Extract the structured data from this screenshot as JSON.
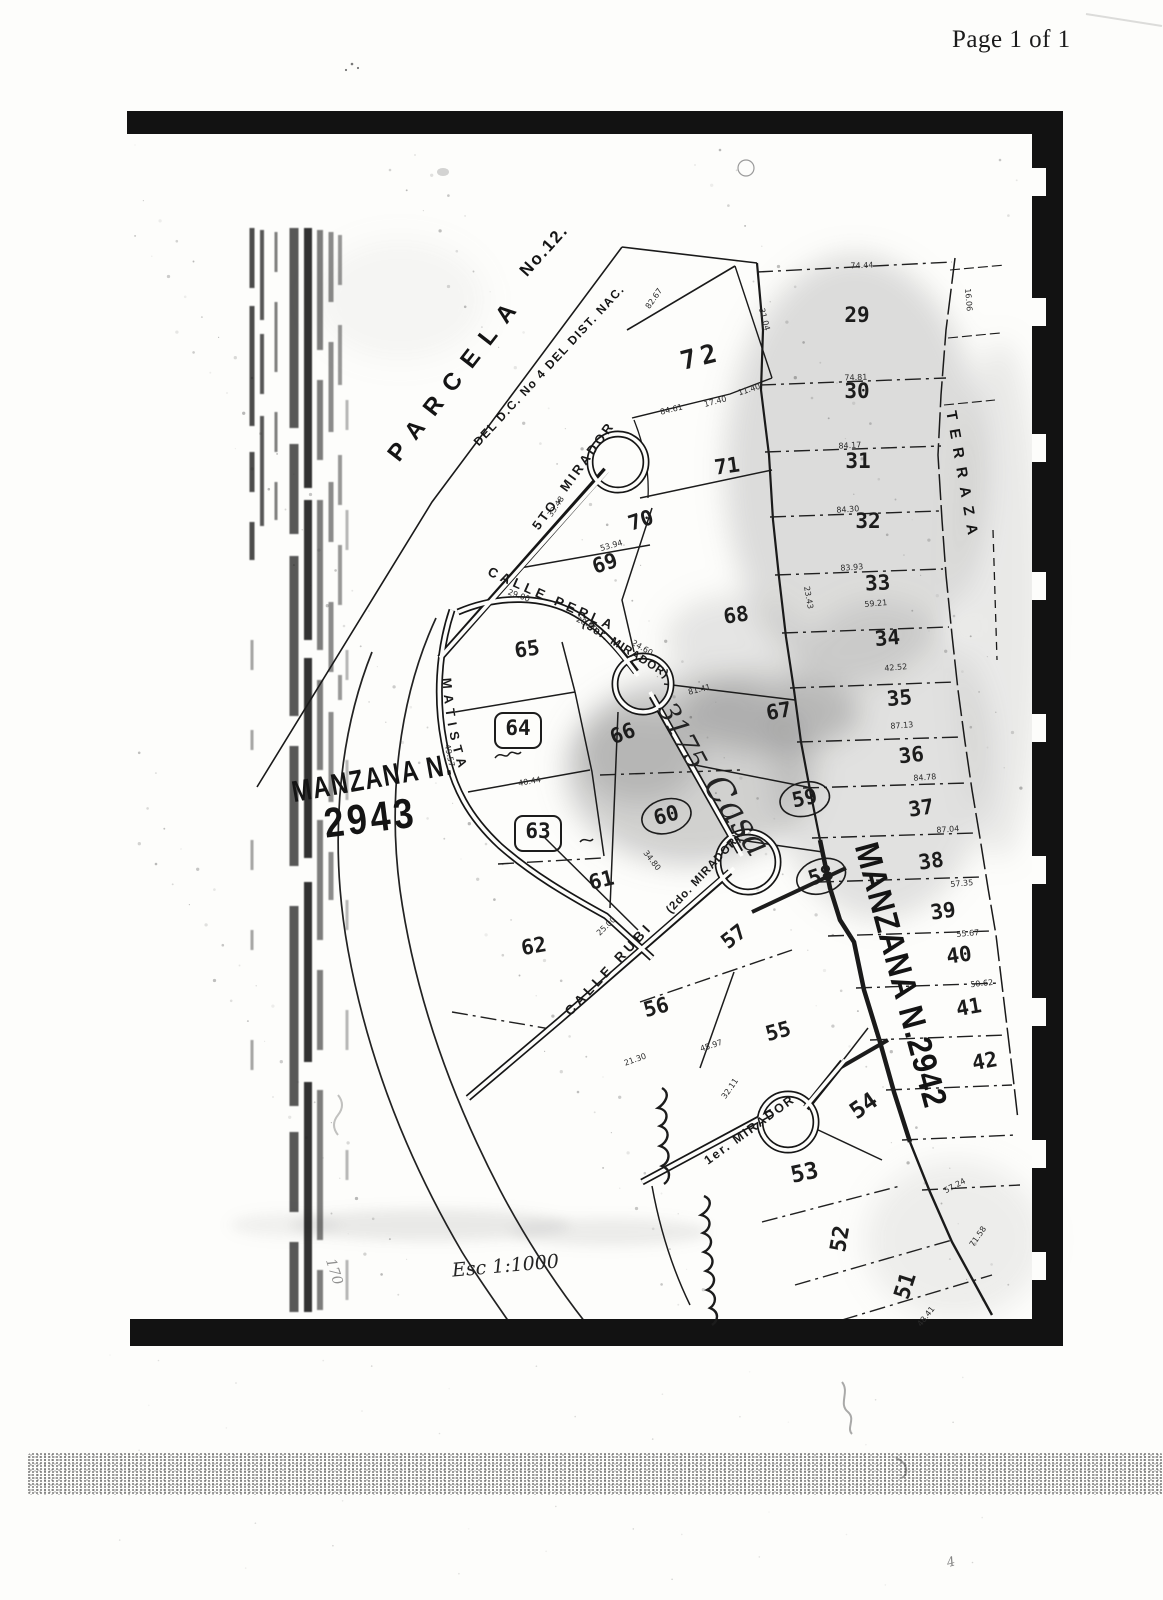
{
  "page": {
    "header": "Page 1 of 1"
  },
  "map": {
    "titles": {
      "parcela": "PARCELA",
      "parcela_no": "No.12.",
      "district_line": "DEL D.C. No 4 DEL DIST. NAC.",
      "terraza": "TERRAZA",
      "manzana_left_line1": "MANZANA N.",
      "manzana_left_line2": "2943",
      "manzana_right": "MANZANA N.2942"
    },
    "amatista": {
      "label": "CALLE AMATISTA"
    },
    "streets": [
      {
        "id": "quinto-mirador",
        "label": "5TO. MIRADOR",
        "x": 577,
        "y": 478,
        "r": -54,
        "s": 13,
        "ls": 3
      },
      {
        "id": "calle-perla",
        "label": "CALLE PERLA",
        "x": 550,
        "y": 603,
        "r": 24,
        "s": 13.5,
        "ls": 4
      },
      {
        "id": "tercer-mirador",
        "label": "(3er. MIRADOR)",
        "x": 624,
        "y": 652,
        "r": 32,
        "s": 11.5,
        "ls": 1
      },
      {
        "id": "calle-rubi",
        "label": "CALLE RUBI",
        "x": 612,
        "y": 972,
        "r": -47,
        "s": 13.5,
        "ls": 4
      },
      {
        "id": "segundo-mirador",
        "label": "(2do. MIRADOR)",
        "x": 706,
        "y": 876,
        "r": -47,
        "s": 11.5,
        "ls": 1
      },
      {
        "id": "primer-mirador",
        "label": "1er. MIRADOR",
        "x": 752,
        "y": 1133,
        "r": -36,
        "s": 12.5,
        "ls": 2
      }
    ],
    "lots": [
      {
        "n": "29",
        "x": 857,
        "y": 322,
        "r": 0
      },
      {
        "n": "30",
        "x": 857,
        "y": 398,
        "r": 0
      },
      {
        "n": "31",
        "x": 858,
        "y": 468,
        "r": 0
      },
      {
        "n": "32",
        "x": 868,
        "y": 528,
        "r": 0
      },
      {
        "n": "33",
        "x": 878,
        "y": 590,
        "r": -3
      },
      {
        "n": "34",
        "x": 888,
        "y": 645,
        "r": -5
      },
      {
        "n": "35",
        "x": 900,
        "y": 705,
        "r": -5
      },
      {
        "n": "36",
        "x": 912,
        "y": 762,
        "r": -6
      },
      {
        "n": "37",
        "x": 922,
        "y": 815,
        "r": -8
      },
      {
        "n": "38",
        "x": 932,
        "y": 868,
        "r": -8
      },
      {
        "n": "39",
        "x": 944,
        "y": 918,
        "r": -8
      },
      {
        "n": "40",
        "x": 960,
        "y": 962,
        "r": -8
      },
      {
        "n": "41",
        "x": 970,
        "y": 1014,
        "r": -10
      },
      {
        "n": "42",
        "x": 986,
        "y": 1068,
        "r": -10
      },
      {
        "n": "51",
        "x": 912,
        "y": 1288,
        "r": -72,
        "s": 22
      },
      {
        "n": "52",
        "x": 847,
        "y": 1240,
        "r": -80,
        "s": 22
      },
      {
        "n": "53",
        "x": 806,
        "y": 1180,
        "r": -12,
        "s": 23
      },
      {
        "n": "54",
        "x": 868,
        "y": 1112,
        "r": -35,
        "s": 23
      },
      {
        "n": "55",
        "x": 780,
        "y": 1038,
        "r": -15
      },
      {
        "n": "56",
        "x": 658,
        "y": 1014,
        "r": -15
      },
      {
        "n": "57",
        "x": 738,
        "y": 942,
        "r": -38
      },
      {
        "n": "58",
        "x": 823,
        "y": 882,
        "r": -18,
        "style": "circled"
      },
      {
        "n": "59",
        "x": 806,
        "y": 805,
        "r": -12,
        "style": "circled"
      },
      {
        "n": "60",
        "x": 668,
        "y": 822,
        "r": -15,
        "style": "circled"
      },
      {
        "n": "61",
        "x": 603,
        "y": 887,
        "r": -14
      },
      {
        "n": "62",
        "x": 535,
        "y": 953,
        "r": -10
      },
      {
        "n": "63",
        "x": 538,
        "y": 838,
        "r": 0,
        "style": "boxed"
      },
      {
        "n": "64",
        "x": 518,
        "y": 735,
        "r": 0,
        "style": "boxed"
      },
      {
        "n": "65",
        "x": 528,
        "y": 656,
        "r": -8
      },
      {
        "n": "66",
        "x": 625,
        "y": 740,
        "r": -20
      },
      {
        "n": "67",
        "x": 780,
        "y": 718,
        "r": -10
      },
      {
        "n": "68",
        "x": 737,
        "y": 622,
        "r": -8
      },
      {
        "n": "69",
        "x": 607,
        "y": 570,
        "r": -18
      },
      {
        "n": "70",
        "x": 643,
        "y": 527,
        "r": -18
      },
      {
        "n": "71",
        "x": 728,
        "y": 473,
        "r": -8
      },
      {
        "n": "72",
        "x": 703,
        "y": 365,
        "r": -14,
        "s": 26,
        "ls": 5
      }
    ],
    "dimensions": [
      {
        "t": "74.44",
        "x": 862,
        "y": 268,
        "r": -2
      },
      {
        "t": "74.81",
        "x": 856,
        "y": 380,
        "r": -2
      },
      {
        "t": "84.17",
        "x": 850,
        "y": 448,
        "r": -3
      },
      {
        "t": "84.30",
        "x": 848,
        "y": 512,
        "r": -4
      },
      {
        "t": "83.93",
        "x": 852,
        "y": 570,
        "r": -4
      },
      {
        "t": "59.21",
        "x": 876,
        "y": 606,
        "r": -5
      },
      {
        "t": "42.52",
        "x": 896,
        "y": 670,
        "r": -5
      },
      {
        "t": "87.13",
        "x": 902,
        "y": 728,
        "r": -4
      },
      {
        "t": "84.78",
        "x": 925,
        "y": 780,
        "r": -4
      },
      {
        "t": "87.04",
        "x": 948,
        "y": 832,
        "r": -4
      },
      {
        "t": "57.35",
        "x": 962,
        "y": 886,
        "r": -5
      },
      {
        "t": "55.67",
        "x": 968,
        "y": 936,
        "r": -5
      },
      {
        "t": "50.62",
        "x": 982,
        "y": 986,
        "r": -6
      },
      {
        "t": "16.06",
        "x": 966,
        "y": 300,
        "r": 85
      },
      {
        "t": "82.67",
        "x": 656,
        "y": 300,
        "r": -55
      },
      {
        "t": "31.04",
        "x": 762,
        "y": 320,
        "r": 75
      },
      {
        "t": "84.61",
        "x": 672,
        "y": 412,
        "r": -14
      },
      {
        "t": "17.40",
        "x": 716,
        "y": 404,
        "r": -15
      },
      {
        "t": "11.40",
        "x": 750,
        "y": 392,
        "r": -18
      },
      {
        "t": "53.94",
        "x": 612,
        "y": 548,
        "r": -16
      },
      {
        "t": "33.48",
        "x": 558,
        "y": 508,
        "r": -56
      },
      {
        "t": "29.00",
        "x": 518,
        "y": 598,
        "r": 20
      },
      {
        "t": "28.66",
        "x": 586,
        "y": 626,
        "r": 25
      },
      {
        "t": "24.60",
        "x": 641,
        "y": 650,
        "r": 30
      },
      {
        "t": "23.43",
        "x": 806,
        "y": 598,
        "r": 80
      },
      {
        "t": "81.41",
        "x": 700,
        "y": 692,
        "r": -14
      },
      {
        "t": "40.44",
        "x": 530,
        "y": 784,
        "r": -10
      },
      {
        "t": "49.57",
        "x": 447,
        "y": 756,
        "r": 78
      },
      {
        "t": "25.00",
        "x": 608,
        "y": 928,
        "r": -44
      },
      {
        "t": "34.80",
        "x": 650,
        "y": 862,
        "r": 52
      },
      {
        "t": "45.97",
        "x": 712,
        "y": 1048,
        "r": -18
      },
      {
        "t": "21.30",
        "x": 636,
        "y": 1062,
        "r": -20
      },
      {
        "t": "32.11",
        "x": 732,
        "y": 1090,
        "r": -55
      },
      {
        "t": "71.58",
        "x": 980,
        "y": 1238,
        "r": -55
      },
      {
        "t": "57.24",
        "x": 956,
        "y": 1188,
        "r": -28
      },
      {
        "t": "48.41",
        "x": 928,
        "y": 1318,
        "r": -52
      }
    ],
    "annotations": {
      "house_number": "3175",
      "casa": "Casa",
      "scale_note": "Esc 1:1000",
      "ghost_170": "170",
      "ghost_4": "4"
    }
  }
}
